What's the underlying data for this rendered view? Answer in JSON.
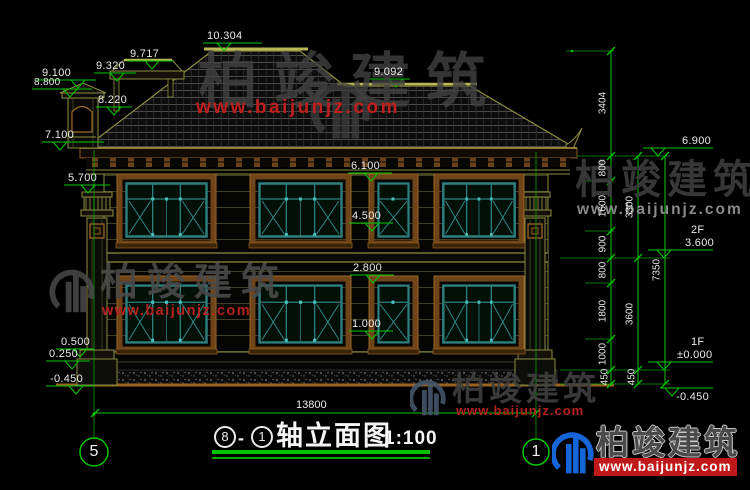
{
  "watermark": {
    "brand": "柏竣建筑",
    "url": "www.baijunjz.com"
  },
  "title": {
    "axis_start": "8",
    "dash": "-",
    "axis_end": "1",
    "name": "轴立面图",
    "scale": "1:100"
  },
  "axes": {
    "left": "5",
    "right": "1"
  },
  "levels": {
    "left": [
      "10.304",
      "9.717",
      "9.320",
      "9.100",
      "8.800",
      "8.220",
      "7.100",
      "5.700",
      "0.500",
      "0.250",
      "-0.450"
    ],
    "middle": [
      "9.092",
      "6.100",
      "4.500",
      "2.800",
      "1.000"
    ],
    "right": {
      "eave": "6.900",
      "f2_tag": "2F",
      "f2": "3.600",
      "f1_tag": "1F",
      "f1": "±0.000",
      "ground": "-0.450"
    }
  },
  "dims": {
    "inner": [
      "3404",
      "800",
      "1600",
      "900",
      "800",
      "1800",
      "1000",
      "450"
    ],
    "mid": [
      "3300",
      "3600",
      "450"
    ],
    "outer": [
      "7350"
    ],
    "width": "13800"
  },
  "colors": {
    "annotation_green": "#00c800",
    "outline_olive": "#8c8c3f",
    "casing_brown": "#6e4418",
    "window_teal": "#2e8080",
    "watermark_red": "#bf1f1f",
    "logo_blue": "#1565d8"
  }
}
